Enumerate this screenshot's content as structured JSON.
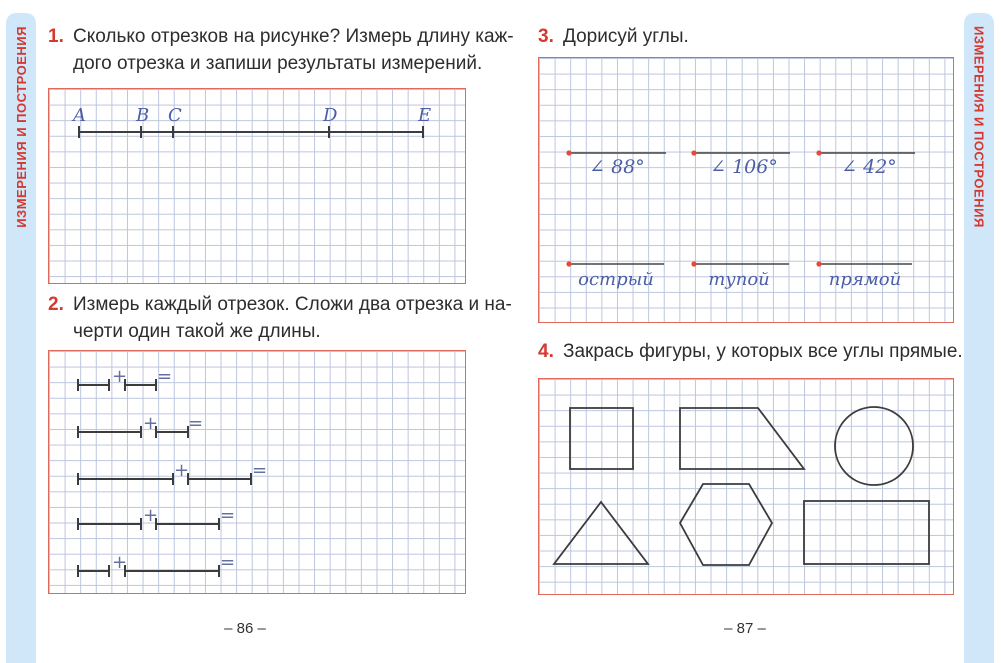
{
  "sidebar": {
    "label": "ИЗМЕРЕНИЯ И ПОСТРОЕНИЯ"
  },
  "left_page": {
    "task1": {
      "number": "1.",
      "line1": "Сколько отрезков на рисунке? Измерь длину каж-",
      "line2": "дого отрезка и запиши результаты измерений."
    },
    "segment_points": [
      "A",
      "B",
      "C",
      "D",
      "E"
    ],
    "task2": {
      "number": "2.",
      "line1": "Измерь каждый отрезок. Сложи два отрезка и на-",
      "line2": "черти один такой же длины."
    },
    "operators": {
      "plus": "+",
      "equals": "="
    },
    "page_number": "– 86 –"
  },
  "right_page": {
    "task3": {
      "number": "3.",
      "text": "Дорисуй углы."
    },
    "angle_labels": [
      "∠ 88°",
      "∠ 106°",
      "∠ 42°"
    ],
    "angle_words": [
      "острый",
      "тупой",
      "прямой"
    ],
    "task4": {
      "number": "4.",
      "text": "Закрась фигуры, у которых все углы прямые."
    },
    "shapes": [
      "square",
      "trapezoid",
      "circle",
      "triangle",
      "hexagon",
      "rectangle"
    ],
    "page_number": "– 87 –"
  },
  "colors": {
    "accent_red": "#d4382f",
    "box_border": "#e0695e",
    "grid_line": "#bcc5de",
    "strip_blue": "#cfe7f8",
    "handwriting_blue": "#4b5ea6",
    "ink": "#3c3c3c"
  }
}
